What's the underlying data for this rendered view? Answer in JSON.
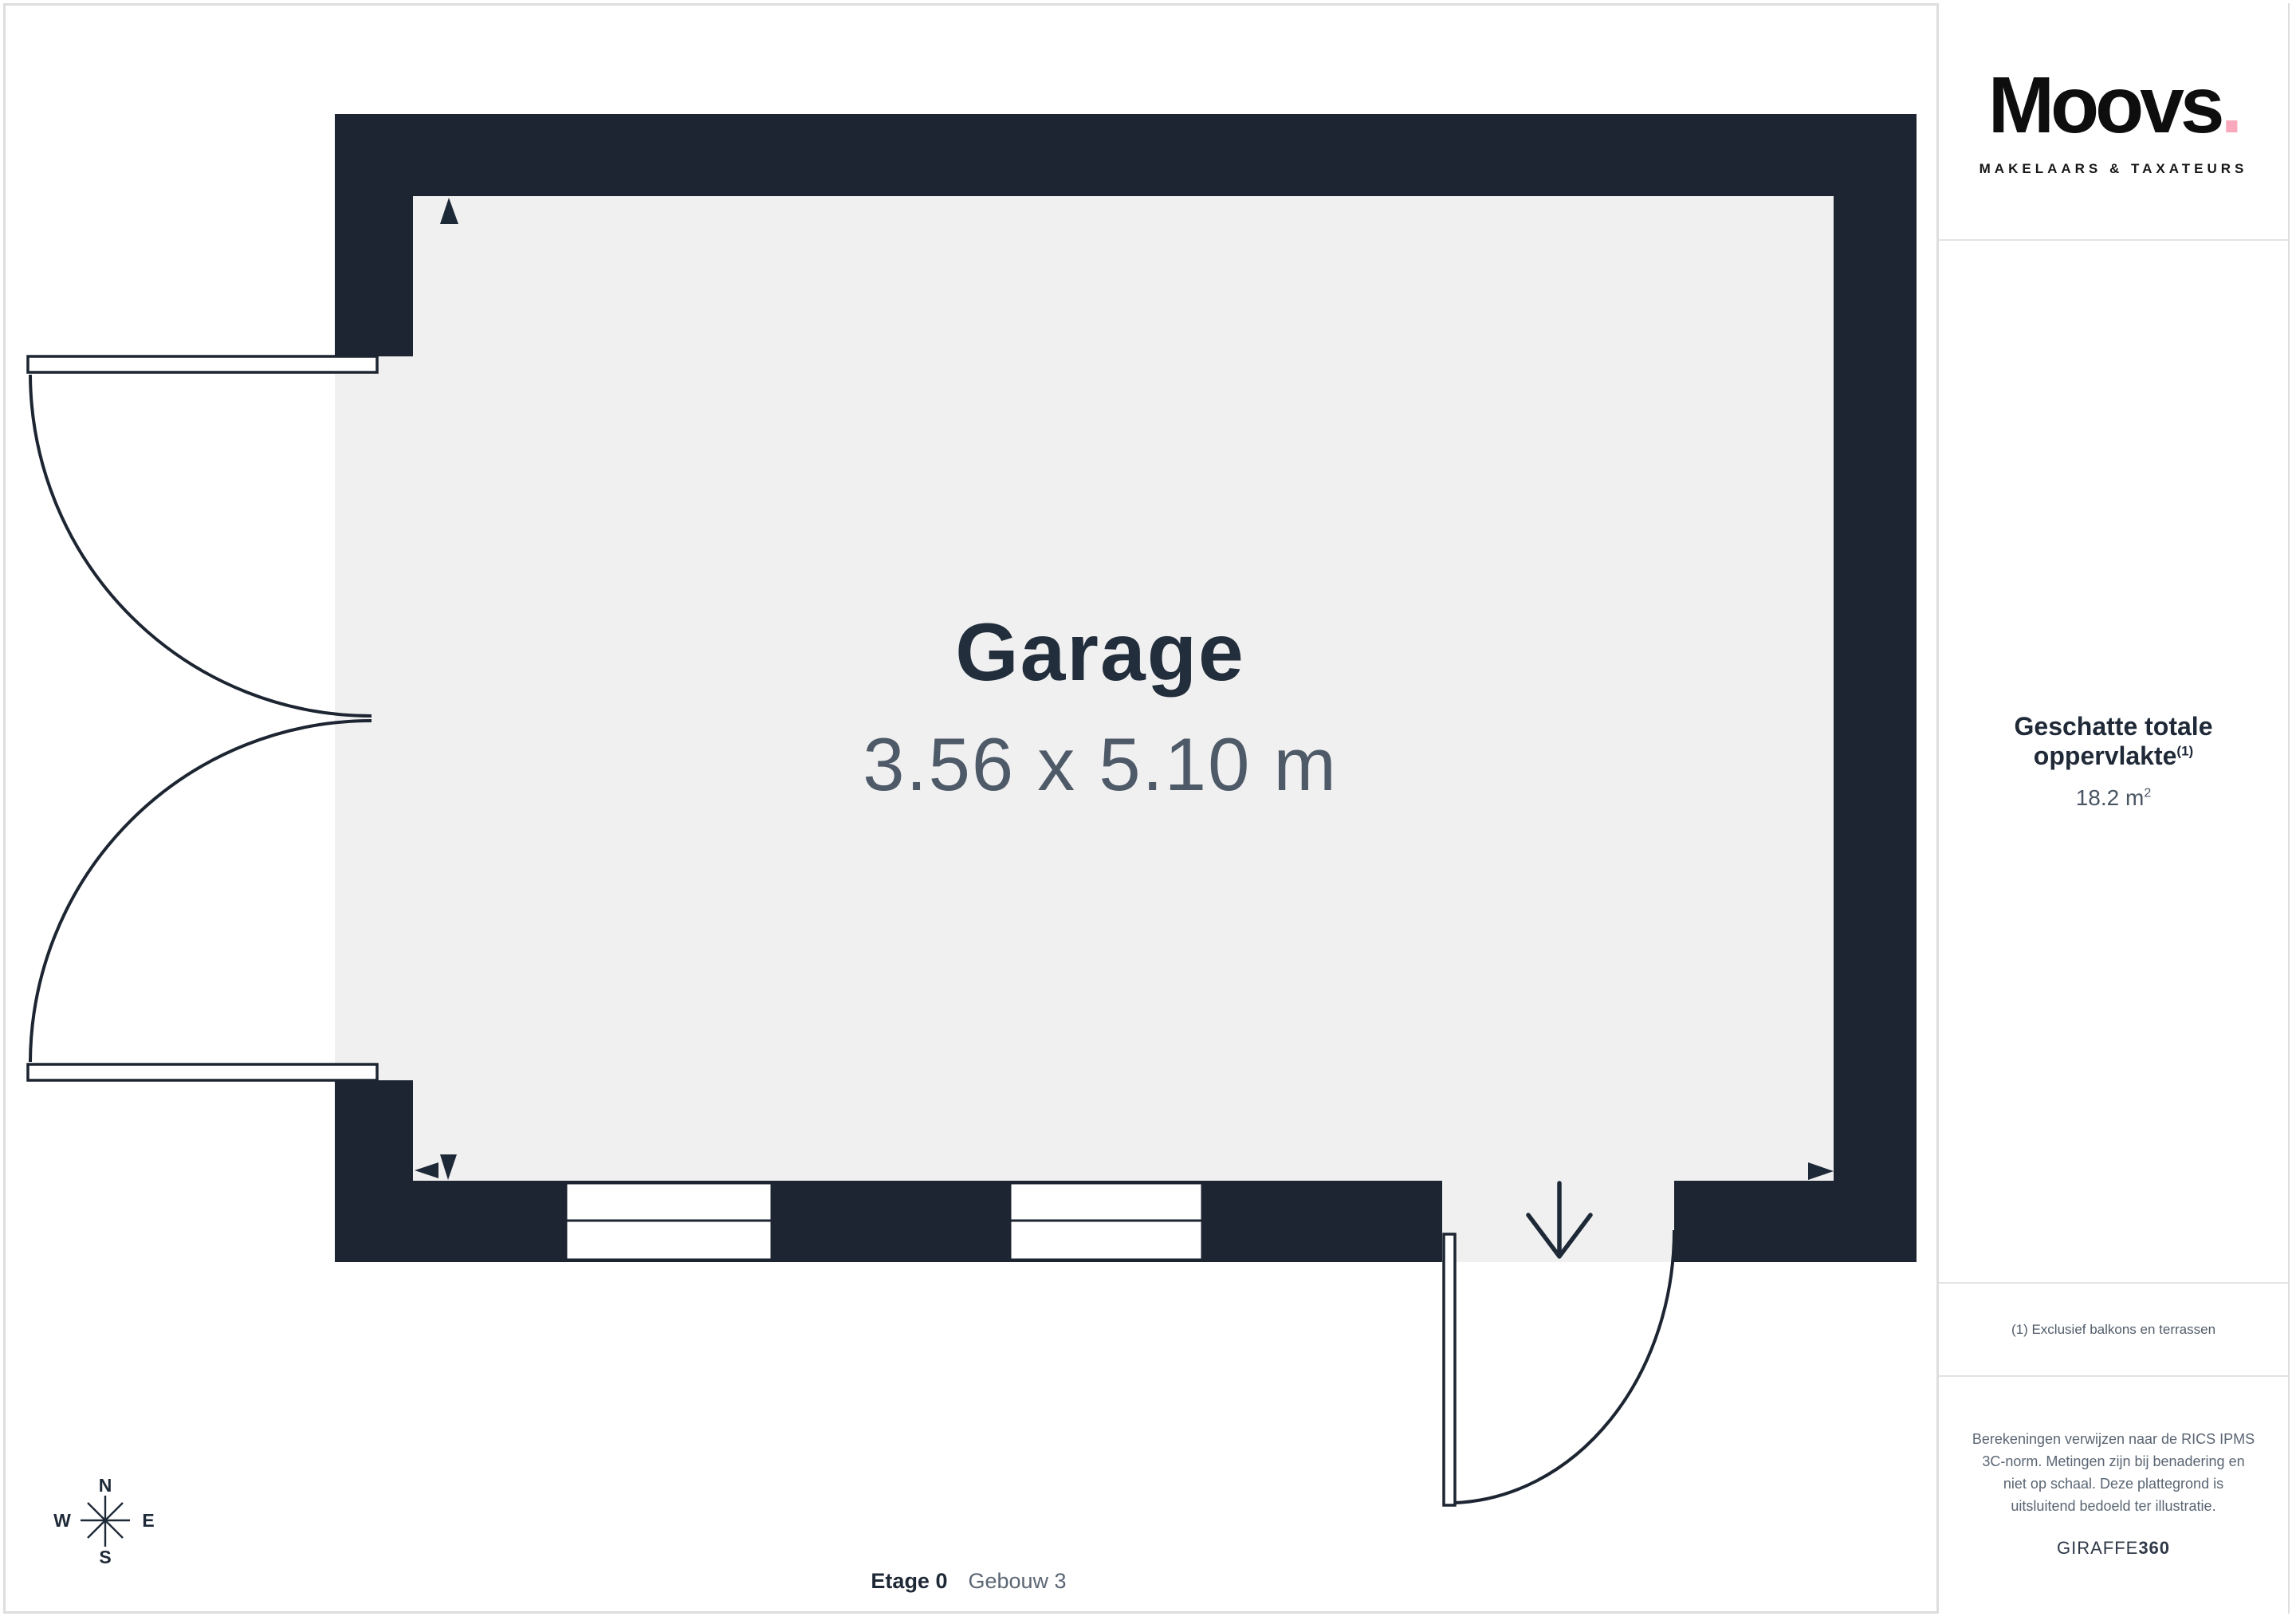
{
  "floorplan": {
    "room_name": "Garage",
    "room_dimensions": "3.56 x 5.10 m",
    "floor_label": {
      "level": "Etage 0",
      "building": "Gebouw 3"
    },
    "compass": {
      "north": "N",
      "east": "E",
      "south": "S",
      "west": "W"
    }
  },
  "sidebar": {
    "logo": {
      "wordmark": "Moovs",
      "dot": ".",
      "tagline": "MAKELAARS & TAXATEURS"
    },
    "area": {
      "heading": "Geschatte totale oppervlakte",
      "heading_sup": "(1)",
      "value": "18.2 m",
      "value_sup": "2"
    },
    "footnote": "(1) Exclusief balkons en terrassen",
    "disclaimer": "Berekeningen verwijzen naar de RICS IPMS 3C-norm. Metingen zijn bij benadering en niet op schaal. Deze plattegrond is uitsluitend bedoeld ter illustratie.",
    "renderer": {
      "brand": "GIRAFFE",
      "suffix": "360"
    }
  },
  "colors": {
    "wall": "#1c2531",
    "floor": "#f0f0f1",
    "accent_pink": "#f9a9bb",
    "text_dark": "#232e3c",
    "text_muted": "#5a6573",
    "divider": "#dedede"
  }
}
